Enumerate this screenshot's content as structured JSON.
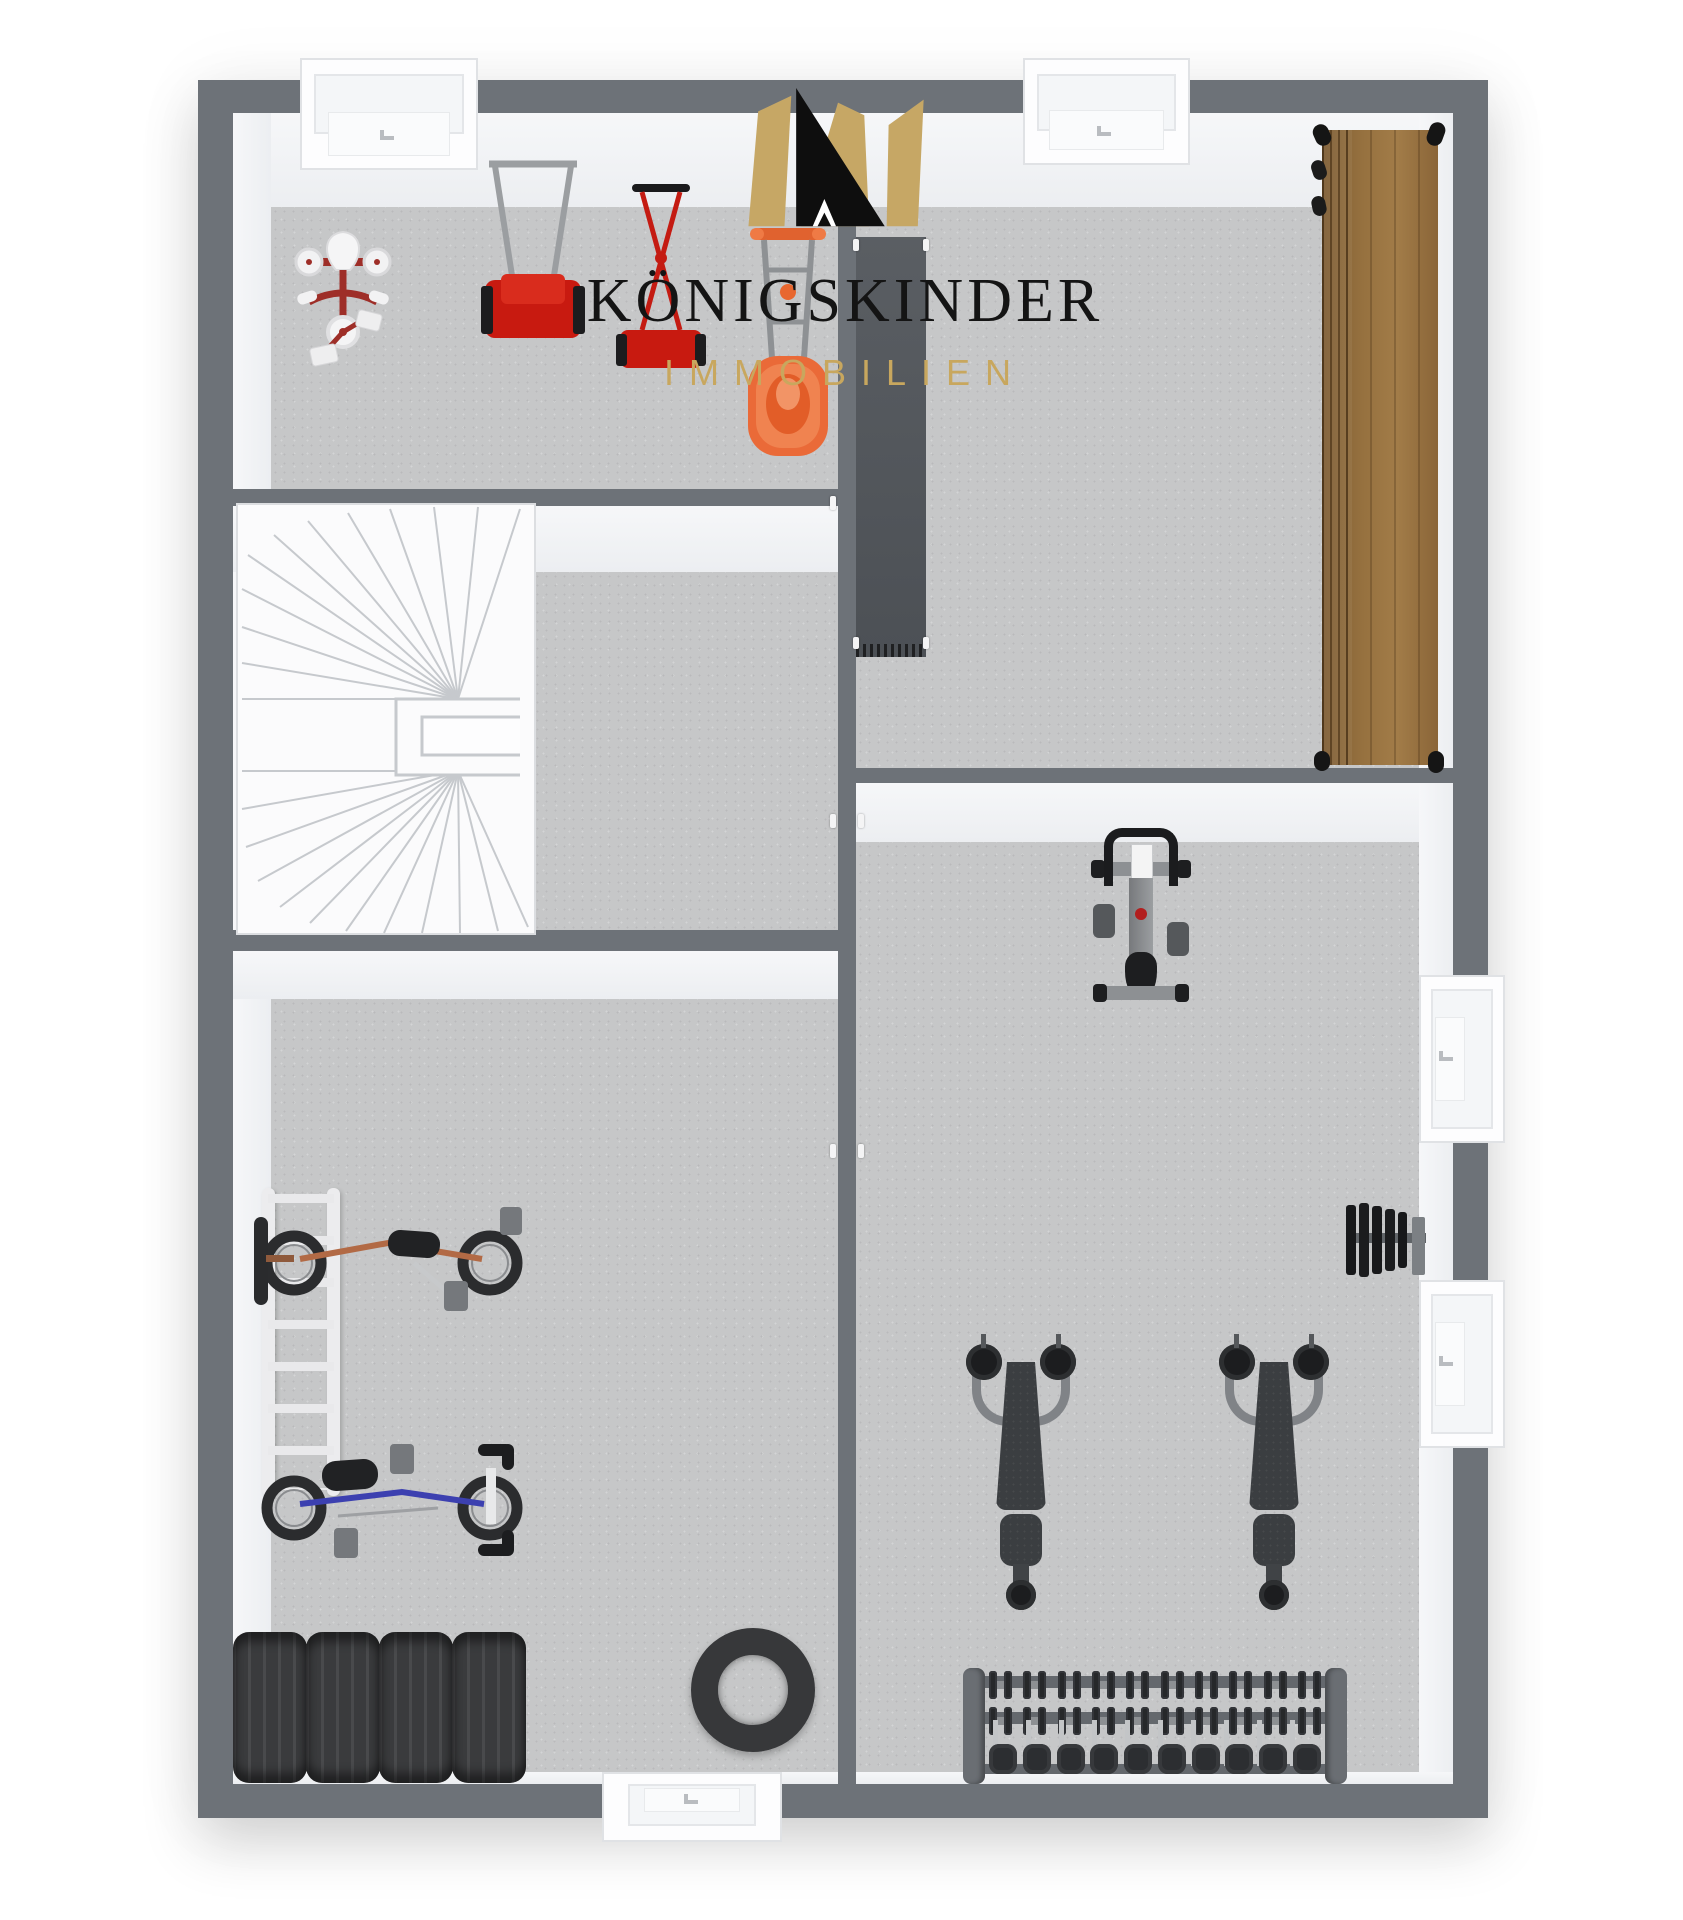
{
  "logo": {
    "brand": "KÖNIGSKINDER",
    "division": "IMMOBILIEN",
    "brand_color": "#141414",
    "division_color": "#c8a75e",
    "crown_gold": "#c6a765",
    "crown_black": "#0e0e0e"
  },
  "palette": {
    "background": "#ffffff",
    "wall": "#6d7278",
    "wall_inner_face": "#f3f4f6",
    "floor_carpet": "#c6c7c8",
    "stair_white": "#fbfbfc",
    "wardrobe_wood": "#96703f",
    "shelf_dark": "#54585e",
    "mower_red": "#c81a10",
    "mower_orange": "#ea6a38",
    "tricycle_red": "#9e2e28",
    "bike_copper": "#b26a45",
    "bike_blue": "#3c40b0",
    "tire_dark": "#3a3b3d",
    "equipment_black": "#1d1e20",
    "equipment_gray": "#8d9093"
  },
  "floorplan": {
    "view": "top-down 3D basement floor plan",
    "rooms": [
      {
        "id": "storage-room-garden",
        "position": "top-left",
        "items": [
          "tricycle",
          "reel-mower-gray-handle",
          "reel-mower-red-handle",
          "electric-mower-orange"
        ]
      },
      {
        "id": "stair-hall",
        "position": "middle-left",
        "items": [
          "winder-staircase"
        ]
      },
      {
        "id": "storage-room-wardrobe",
        "position": "top-right",
        "items": [
          "dark-shelf-unit",
          "wooden-wardrobe"
        ]
      },
      {
        "id": "bike-storage-room",
        "position": "bottom-left",
        "items": [
          "white-ladder",
          "copper-bike",
          "blue-bike",
          "tire-row-of-four",
          "spare-tire-flat"
        ]
      },
      {
        "id": "home-gym",
        "position": "right",
        "items": [
          "spin-bike",
          "wall-mounted-weight-plates",
          "incline-bench-left",
          "incline-bench-right",
          "dumbbell-rack"
        ]
      }
    ],
    "openings": {
      "top_windows": 2,
      "right_windows": 2,
      "bottom_windows": 1
    }
  }
}
